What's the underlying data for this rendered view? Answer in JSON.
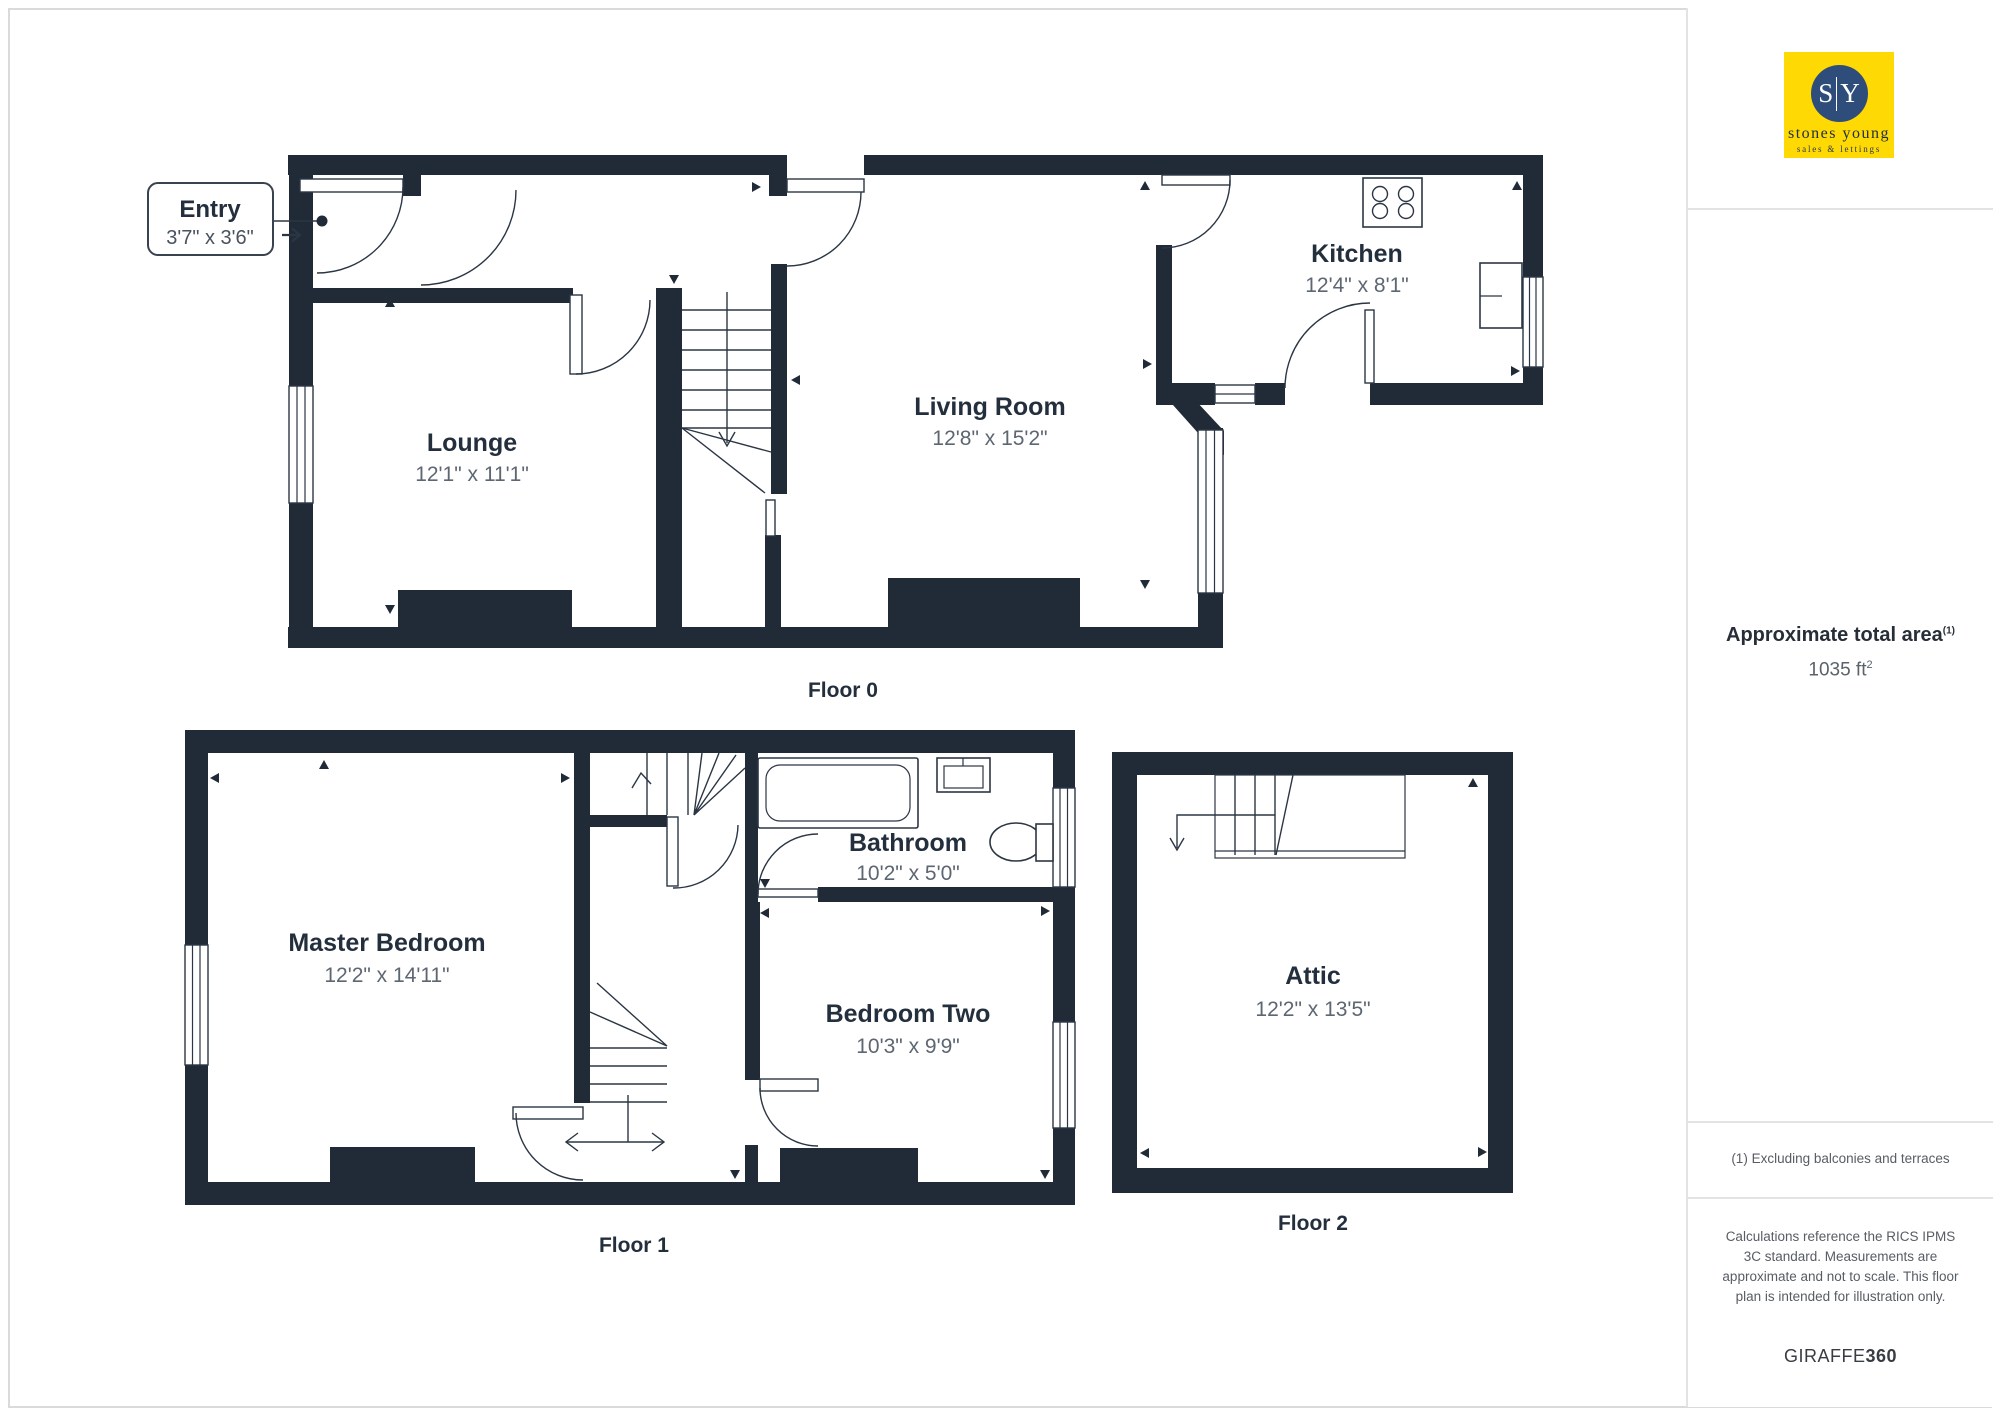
{
  "brand": {
    "initial_left": "S",
    "initial_right": "Y",
    "name": "stones young",
    "tagline": "sales & lettings"
  },
  "sidebar": {
    "area_heading": "Approximate total area",
    "area_marker": "(1)",
    "area_value": "1035 ft",
    "area_value_sup": "2",
    "footnote": "(1) Excluding balconies and terraces",
    "disclaimer": "Calculations reference the RICS IPMS 3C standard. Measurements are approximate and not to scale. This floor plan is intended for illustration only.",
    "footer_brand_regular": "GIRAFFE",
    "footer_brand_bold": "360"
  },
  "floors": [
    {
      "caption": "Floor 0",
      "rooms": [
        {
          "name": "Entry",
          "dims": "3'7\" x 3'6\""
        },
        {
          "name": "Lounge",
          "dims": "12'1\" x 11'1\""
        },
        {
          "name": "Living Room",
          "dims": "12'8\" x 15'2\""
        },
        {
          "name": "Kitchen",
          "dims": "12'4\" x 8'1\""
        }
      ]
    },
    {
      "caption": "Floor 1",
      "rooms": [
        {
          "name": "Master Bedroom",
          "dims": "12'2\" x 14'11\""
        },
        {
          "name": "Bathroom",
          "dims": "10'2\" x 5'0\""
        },
        {
          "name": "Bedroom Two",
          "dims": "10'3\" x 9'9\""
        }
      ]
    },
    {
      "caption": "Floor 2",
      "rooms": [
        {
          "name": "Attic",
          "dims": "12'2\" x 13'5\""
        }
      ]
    }
  ],
  "colors": {
    "wall": "#212B38",
    "line": "#2B3644",
    "name": "#242F3D",
    "dims": "#5D6671",
    "accent": "#FFD903",
    "circle": "#2E4D7B"
  }
}
